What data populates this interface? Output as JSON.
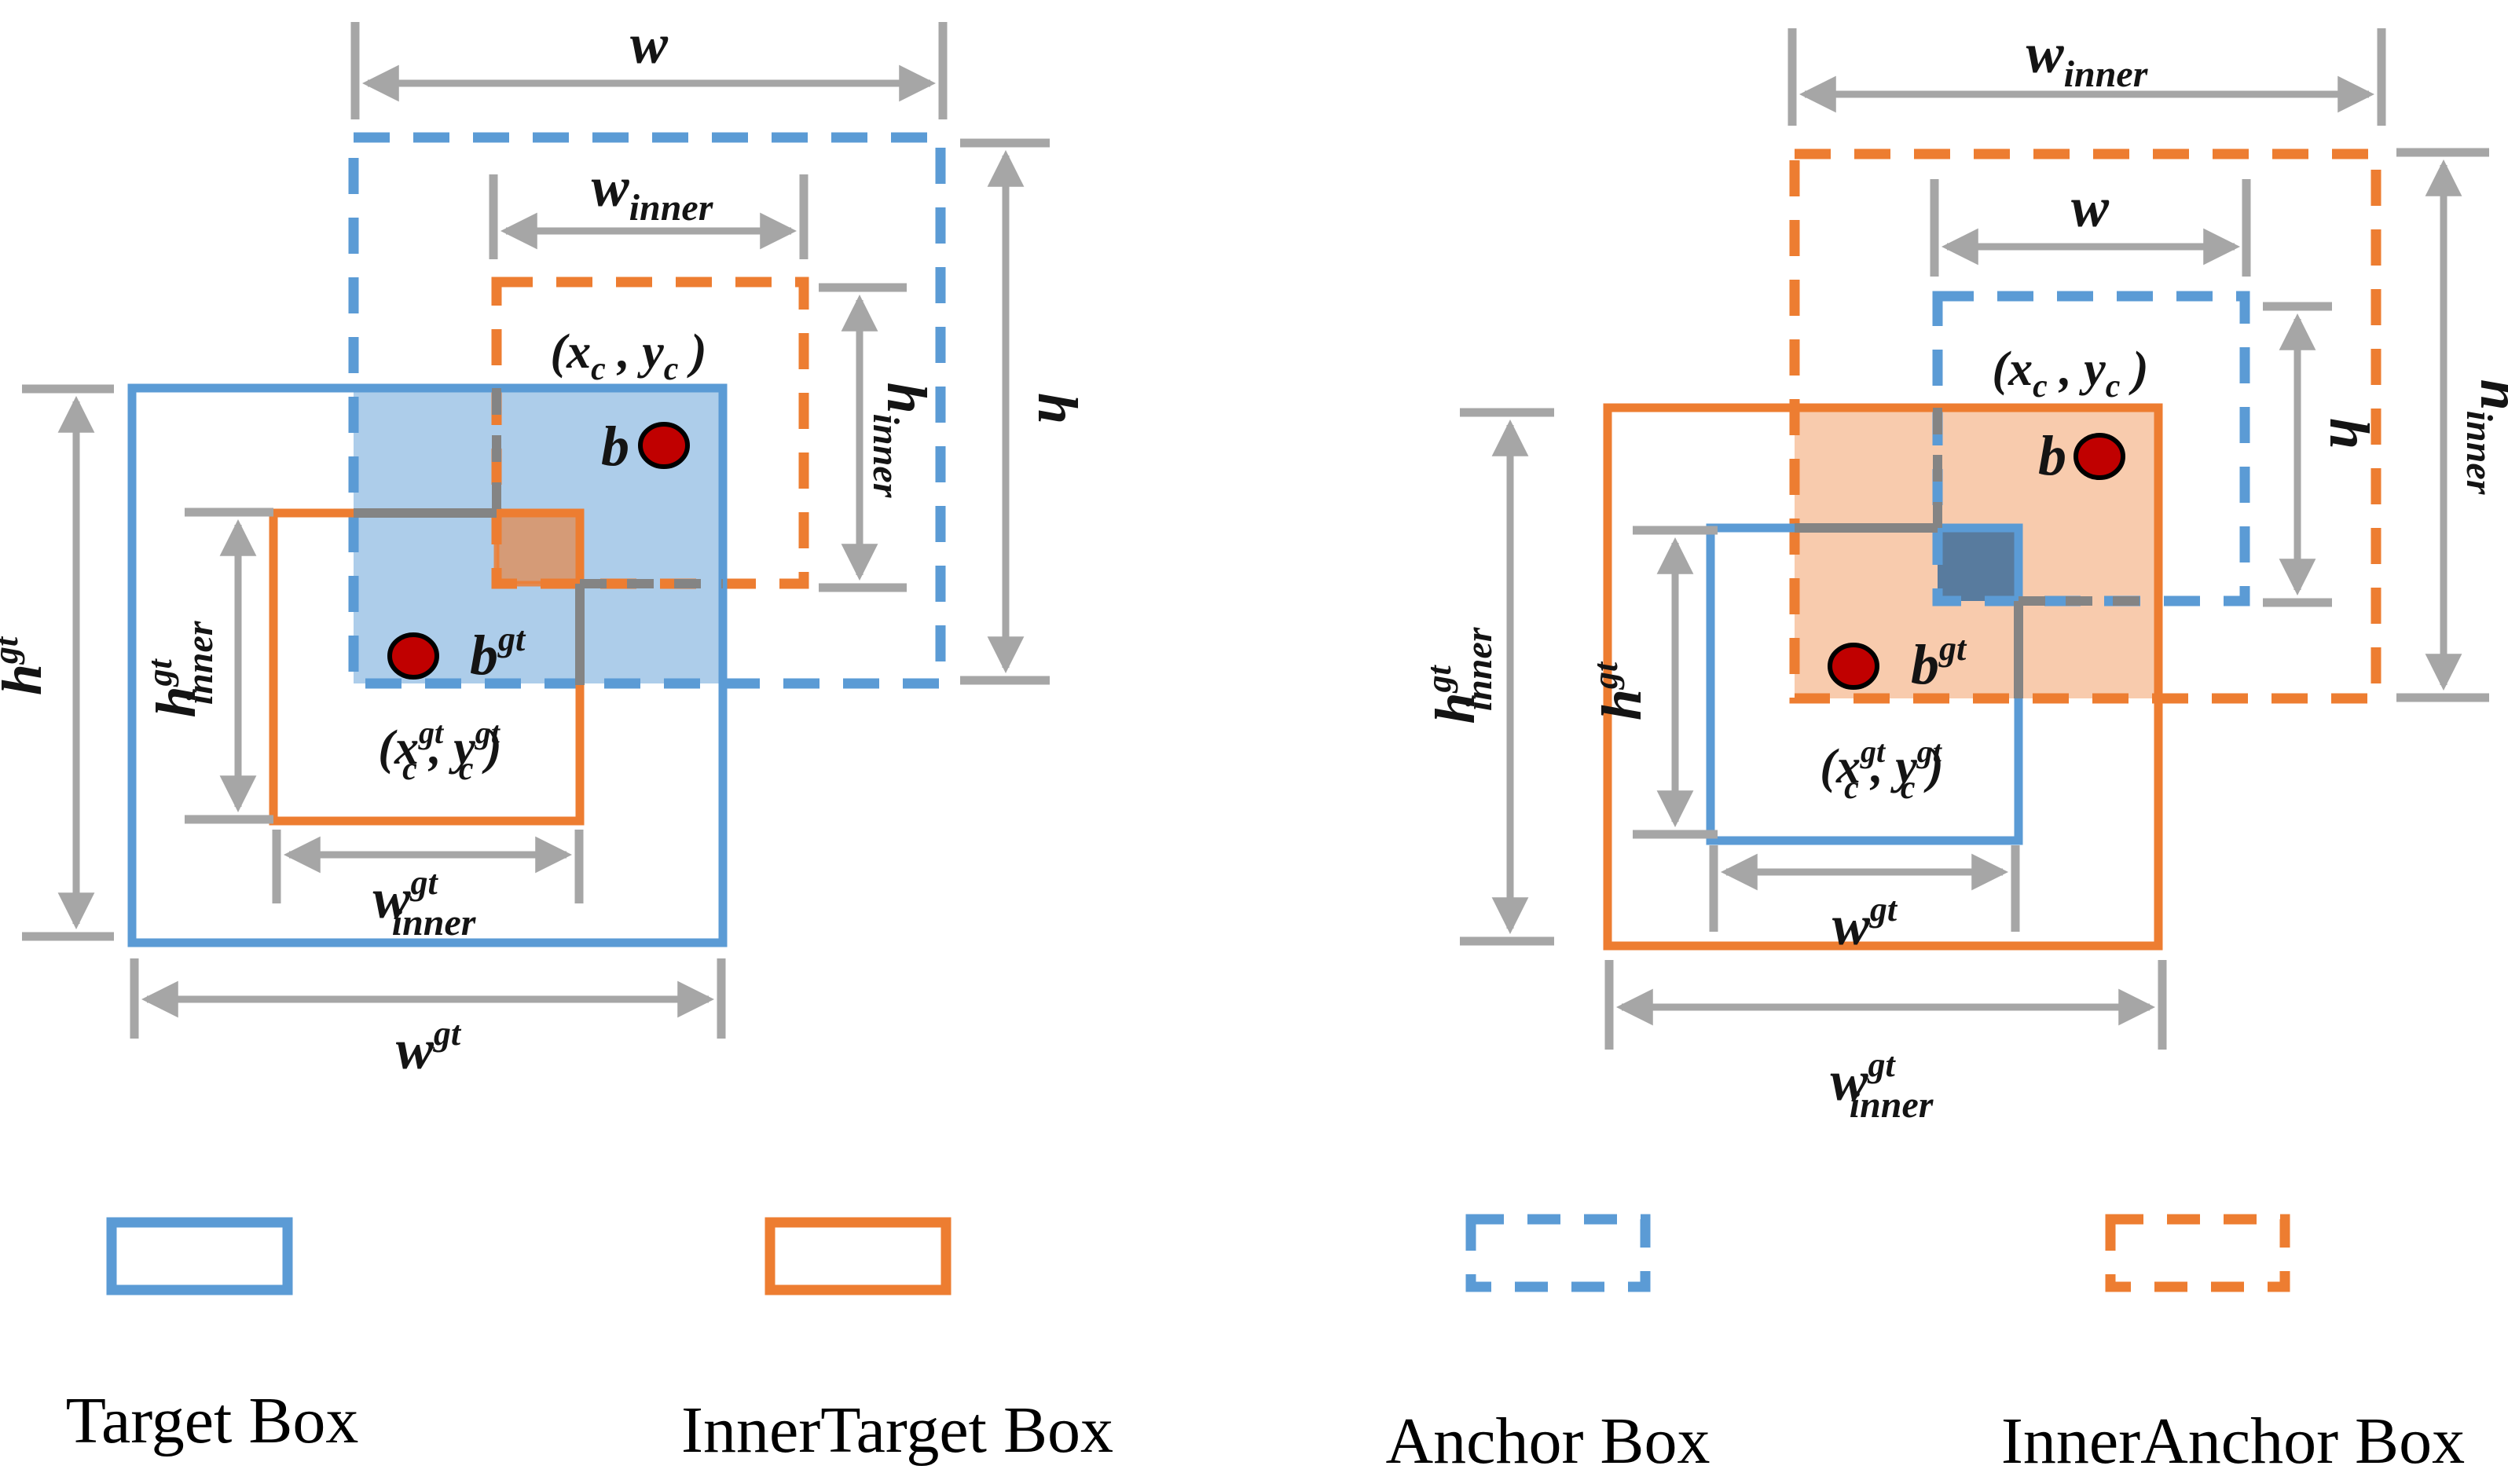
{
  "figure": {
    "description_labels": {
      "w": "w",
      "h": "h",
      "b": "b",
      "gt": "gt",
      "inner": "inner",
      "c": "c",
      "center_open": "(x",
      "center_mid": " , y",
      "center_close": " )"
    },
    "colors": {
      "target_box_blue": "#5B9BD5",
      "inner_box_orange": "#ED7D31",
      "dimension_gray": "#A6A6A6",
      "hidden_line_gray": "#848484",
      "center_dot_red": "#C00000",
      "text_black": "#141414",
      "overlap_blue_fill": "rgba(91,155,213,0.50)",
      "overlap_brown_fill": "rgba(237,125,49,0.62)",
      "overlap_orange_fill": "rgba(237,125,49,0.40)",
      "overlap_steel_fill": "rgba(47,102,154,0.80)"
    },
    "legend": {
      "items": [
        {
          "label": "Target Box",
          "style": "solid",
          "color": "#5B9BD5"
        },
        {
          "label": "InnerTarget Box",
          "style": "solid",
          "color": "#ED7D31"
        },
        {
          "label": "Anchor Box",
          "style": "dashed",
          "color": "#5B9BD5"
        },
        {
          "label": "InnerAnchor Box",
          "style": "dashed",
          "color": "#ED7D31"
        }
      ]
    }
  }
}
